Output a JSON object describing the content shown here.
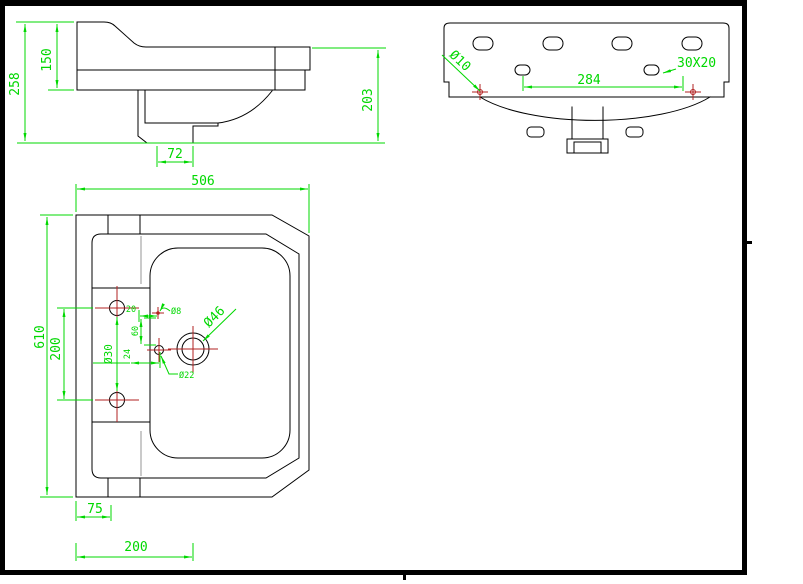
{
  "colors": {
    "background": "#ffffff",
    "line": "#000000",
    "dim": "#00d800",
    "marker": "#b22222",
    "ghost": "#bdbdbd",
    "frame": "#000000"
  },
  "side_view": {
    "overall_height": "258",
    "back_height": "150",
    "front_height": "203",
    "trap_width": "72"
  },
  "back_view": {
    "fixing_hole_dia": "Ø10",
    "fixing_hole_spacing": "284",
    "slot_size": "30X20"
  },
  "plan_view": {
    "width": "506",
    "depth": "610",
    "tap_hole_spacing": "200",
    "tap_hole_dia": "Ø30",
    "small_hole_dia": "Ø8",
    "waste_dia": "Ø46",
    "overflow_dia": "Ø22",
    "offset_a": "20",
    "offset_b": "60",
    "offset_c": "24",
    "ledge_offset": "75",
    "waste_offset": "200"
  }
}
